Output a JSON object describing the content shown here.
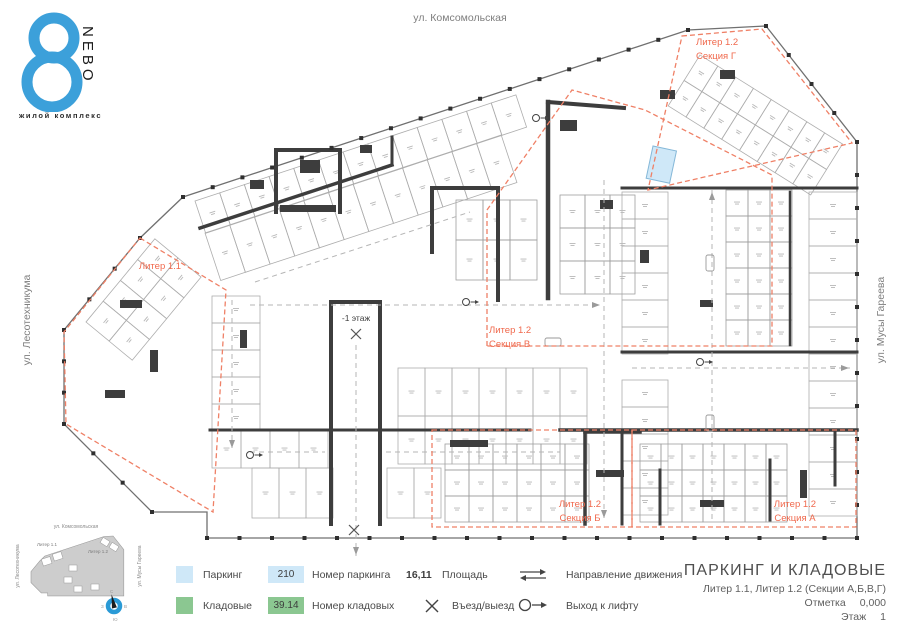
{
  "logo": {
    "brand_vertical": "NEBO",
    "tagline": "жилой комплекс"
  },
  "streets": {
    "top": "ул. Комсомольская",
    "left": "ул. Лесотехникума",
    "right": "ул. Мусы Гареева"
  },
  "plan": {
    "ramp_label": "-1 этаж",
    "sections": {
      "liter11": {
        "label": "Литер 1.1"
      },
      "g": {
        "line1": "Литер 1.2",
        "line2": "Секция Г"
      },
      "v": {
        "line1": "Литер 1.2",
        "line2": "Секция В"
      },
      "b": {
        "line1": "Литер 1.2",
        "line2": "Секция Б"
      },
      "a": {
        "line1": "Литер 1.2",
        "line2": "Секция А"
      }
    }
  },
  "legend": {
    "parking_label": "Паркинг",
    "storage_label": "Кладовые",
    "parking_number_example": "210",
    "parking_number_label": "Номер паркинга",
    "storage_number_example": "39.14",
    "storage_number_label": "Номер кладовых",
    "area_example": "16,11",
    "area_label": "Площадь",
    "entry_label": "Въезд/выезд",
    "direction_label": "Направление движения",
    "lift_label": "Выход к лифту"
  },
  "title_block": {
    "title": "ПАРКИНГ И КЛАДОВЫЕ",
    "subtitle": "Литер 1.1, Литер 1.2 (Секции А,Б,В,Г)",
    "mark_label": "Отметка",
    "mark_value": "0,000",
    "floor_label": "Этаж",
    "floor_value": "1"
  },
  "minimap": {
    "street_top": "ул. Комсомольская",
    "street_left": "ул. Лесотехникума",
    "street_right": "ул. Мусы Гареева",
    "liter11": "Литер 1.1",
    "liter12": "Литер 1.2",
    "compass": {
      "n": "С",
      "e": "В",
      "s": "Ю",
      "w": "З"
    }
  },
  "colors": {
    "parking_blue": "#cfe8f8",
    "storage_green": "#8bc791",
    "accent_red": "#f0694d",
    "dash_red": "#ef8066",
    "wall_dark": "#3d3d3d",
    "logo_blue": "#3ca0da"
  }
}
